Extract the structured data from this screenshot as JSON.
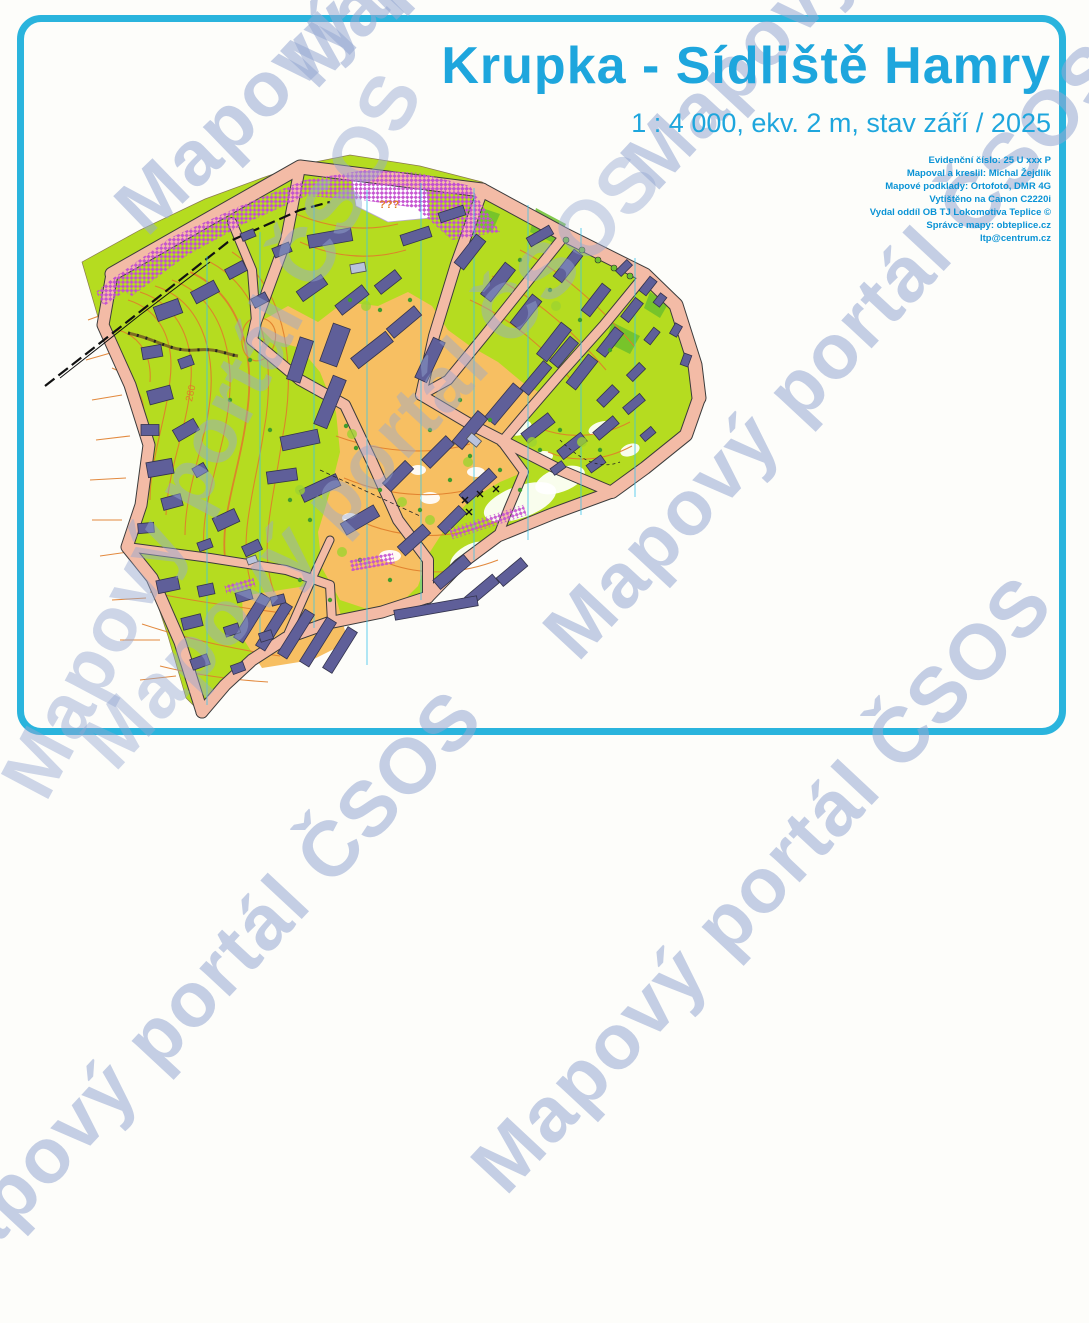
{
  "page": {
    "title": "Krupka - Sídliště Hamry",
    "subtitle": "1 : 4 000, ekv. 2 m, stav září / 2025"
  },
  "imprint": {
    "lines": [
      "Evidenční číslo: 25 U xxx P",
      "Mapoval a kreslil: Michal Žejdlík",
      "Mapové podklady: Ortofoto, DMR 4G",
      "Vytištěno na Canon C2220i",
      "Vydal oddíl OB TJ Lokomotiva Teplice ©",
      "Správce mapy: obteplice.cz",
      "ltp@centrum.cz"
    ]
  },
  "watermark": {
    "text": "Mapový portál ČSOS"
  },
  "map": {
    "labels": {
      "unknown_area": "???",
      "contour_elevation": "280"
    },
    "colors": {
      "rough_open_green": "#b5dc20",
      "open_orange": "#f7bf62",
      "building": "#5f5f99",
      "road": "#f3bba6",
      "contour": "#e07d2a",
      "out_of_bounds": "#c44fd0",
      "north_line": "#3cc6ea",
      "frame_border": "#2ab4dd",
      "title_text": "#1ea6dd",
      "watermark": "#96a8d2"
    }
  }
}
